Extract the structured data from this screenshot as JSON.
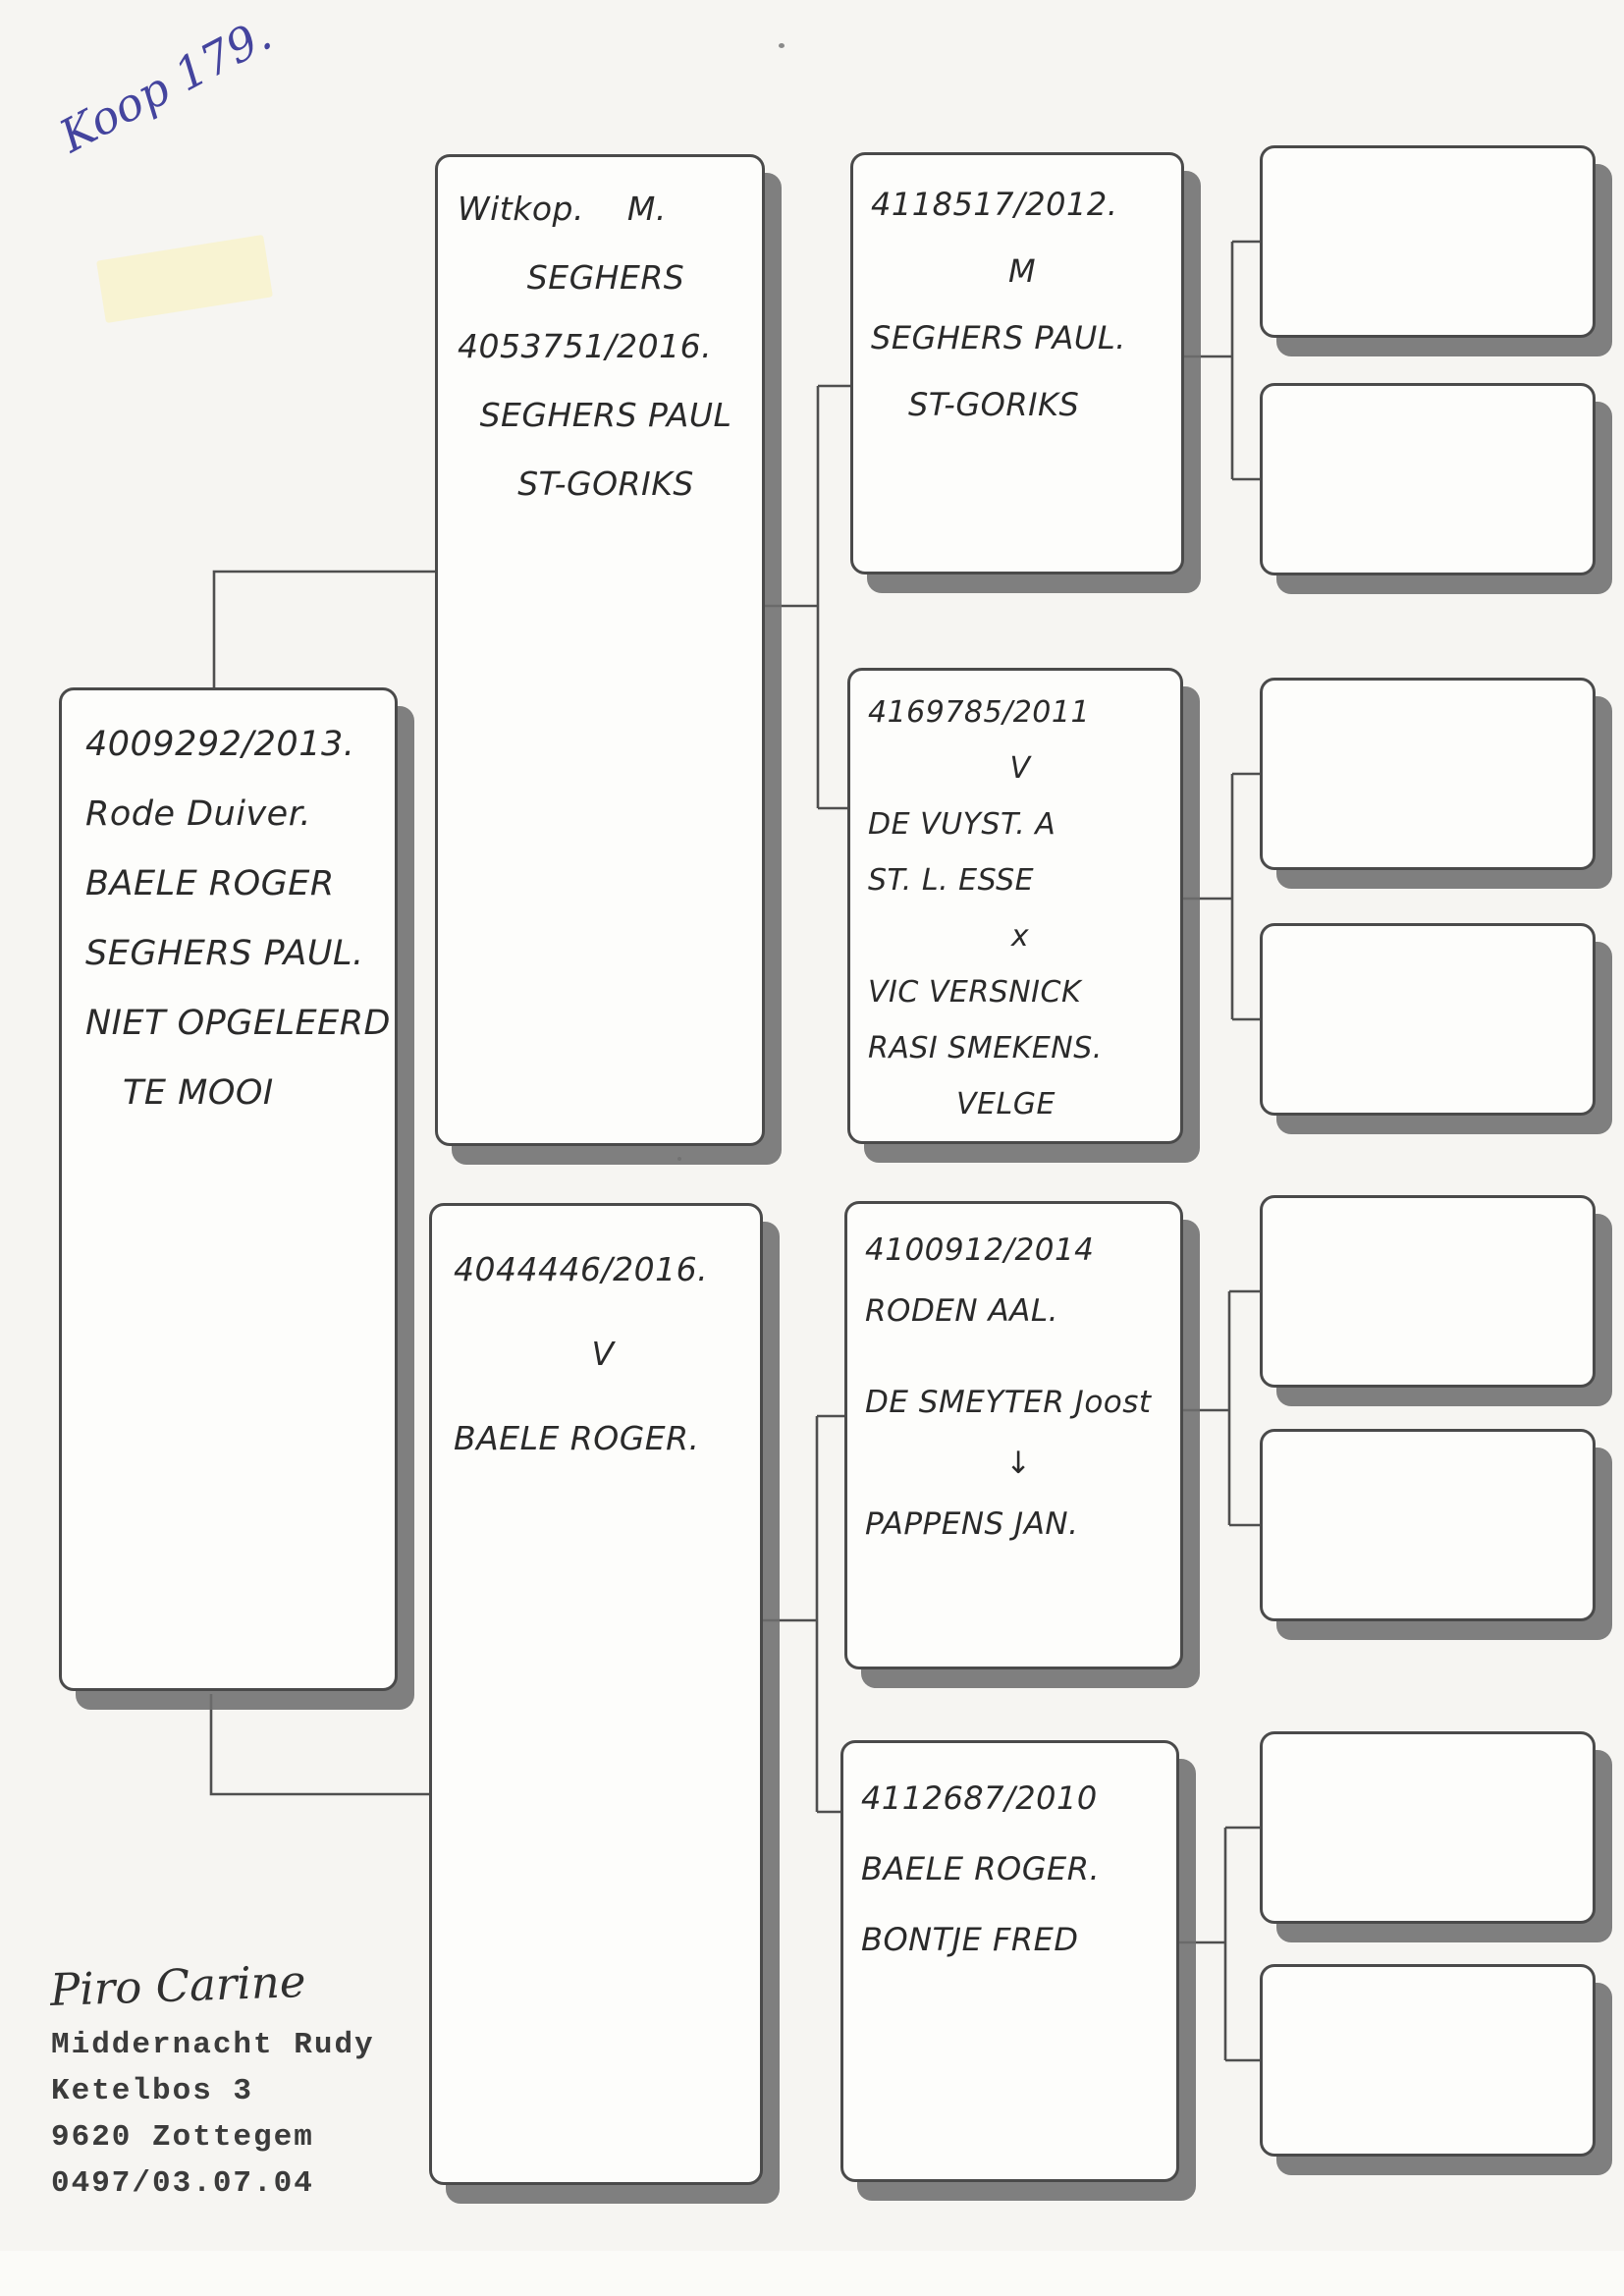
{
  "page": {
    "note_top_left": "Koop 179.",
    "ink_color": "#44449e"
  },
  "pedigree": {
    "subject": {
      "lines": [
        "4009292/2013.",
        "Rode Duiver.",
        "BAELE ROGER",
        "SEGHERS PAUL.",
        "NIET OPGELEERD",
        "TE MOOI"
      ]
    },
    "sire": {
      "lines": [
        "Witkop.    M.",
        "SEGHERS",
        "4053751/2016.",
        "SEGHERS PAUL",
        "ST-GORIKS"
      ]
    },
    "dam": {
      "lines": [
        "4044446/2016.",
        "V",
        "BAELE ROGER."
      ]
    },
    "grandparent_1": {
      "lines": [
        "4118517/2012.",
        "M",
        "SEGHERS PAUL.",
        "ST-GORIKS"
      ]
    },
    "grandparent_2": {
      "lines": [
        "4169785/2011",
        "V",
        "DE VUYST. A",
        "ST. L. ESSE",
        "x",
        "VIC VERSNICK",
        "RASI SMEKENS.",
        "VELGE"
      ]
    },
    "grandparent_3": {
      "lines": [
        "4100912/2014",
        "RODEN AAL.",
        "",
        "DE SMEYTER Joost",
        "↓",
        "PAPPENS JAN."
      ]
    },
    "grandparent_4": {
      "lines": [
        "4112687/2010",
        "BAELE ROGER.",
        "BONTJE FRED"
      ]
    },
    "great_grandparents": [
      "",
      "",
      "",
      "",
      "",
      "",
      "",
      ""
    ]
  },
  "owner": {
    "signature": "Piro Carine",
    "name": "Middernacht Rudy",
    "street": "Ketelbos 3",
    "city": "9620 Zottegem",
    "phone": "0497/03.07.04"
  }
}
